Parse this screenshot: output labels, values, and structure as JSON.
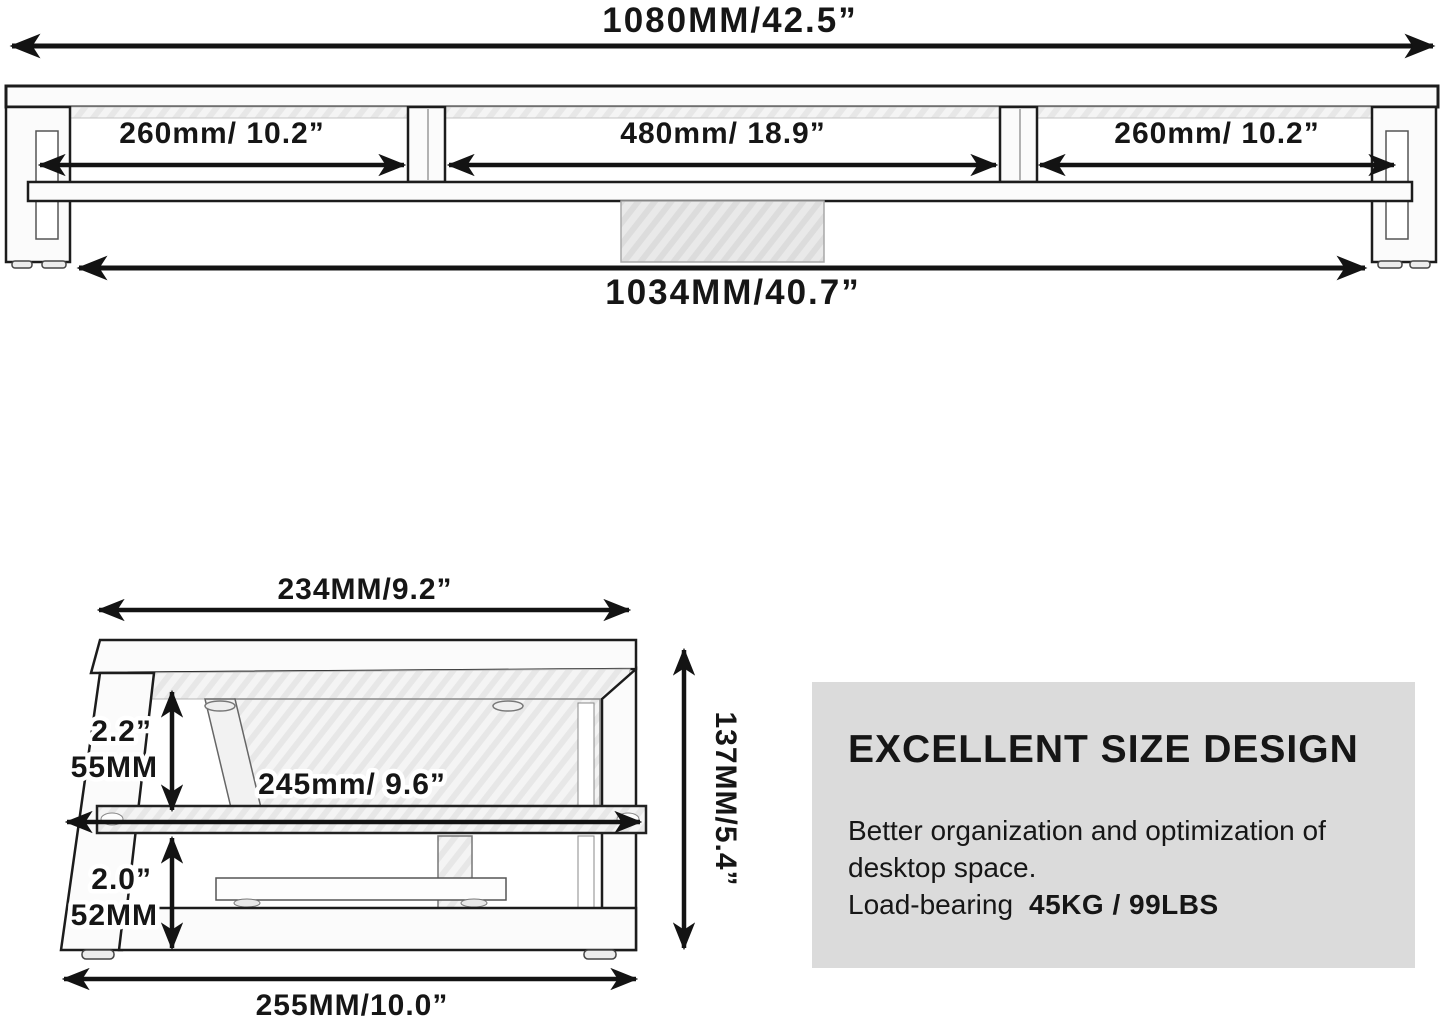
{
  "front_view": {
    "top_width_label": "1080MM/42.5”",
    "left_opening_label": "260mm/ 10.2”",
    "center_opening_label": "480mm/ 18.9”",
    "right_opening_label": "260mm/ 10.2”",
    "bottom_width_label": "1034MM/40.7”"
  },
  "side_view": {
    "top_depth_label": "234MM/9.2”",
    "upper_gap_inches": "2.2”",
    "upper_gap_mm": "55MM",
    "middle_depth_label": "245mm/ 9.6”",
    "lower_gap_inches": "2.0”",
    "lower_gap_mm": "52MM",
    "height_label": "137MM/5.4”",
    "bottom_depth_label": "255MM/10.0”"
  },
  "info_box": {
    "title": "EXCELLENT SIZE DESIGN",
    "body_line1": "Better organization and optimization of",
    "body_line2": "desktop space.",
    "load_label": "Load-bearing",
    "load_value": "45KG / 99LBS",
    "bg_color": "#dbdbdb",
    "text_color": "#161616"
  }
}
